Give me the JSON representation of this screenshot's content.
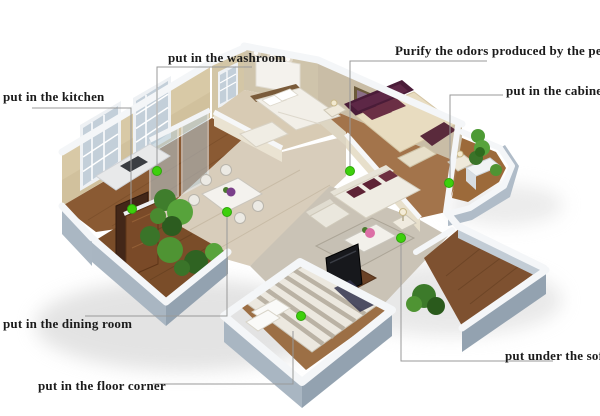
{
  "colors": {
    "background": "#ffffff",
    "label_text": "#1b1b1b",
    "leader_line": "#999999",
    "marker_fill": "#3ed00c",
    "marker_stroke": "#2ea50b"
  },
  "annotations": [
    {
      "id": "kitchen",
      "label": "put in the kitchen",
      "label_x": 3,
      "label_y": 90,
      "line": [
        [
          32,
          108
        ],
        [
          131,
          108
        ],
        [
          131,
          205
        ]
      ],
      "dot": [
        132,
        209
      ]
    },
    {
      "id": "washroom",
      "label": "put in the washroom",
      "label_x": 168,
      "label_y": 51,
      "line": [
        [
          252,
          67
        ],
        [
          157,
          67
        ],
        [
          157,
          166
        ]
      ],
      "dot": [
        157,
        171
      ]
    },
    {
      "id": "pets",
      "label": "Purify the odors produced by the pets",
      "label_x": 395,
      "label_y": 44,
      "line": [
        [
          487,
          61
        ],
        [
          350,
          61
        ],
        [
          350,
          166
        ]
      ],
      "dot": [
        350,
        171
      ]
    },
    {
      "id": "cabinet",
      "label": "put in the cabinet",
      "label_x": 506,
      "label_y": 84,
      "line": [
        [
          503,
          95
        ],
        [
          450,
          95
        ],
        [
          450,
          178
        ]
      ],
      "dot": [
        449,
        183
      ]
    },
    {
      "id": "dining-room",
      "label": "put in the dining room",
      "label_x": 3,
      "label_y": 317,
      "line": [
        [
          85,
          316
        ],
        [
          227,
          316
        ],
        [
          227,
          217
        ]
      ],
      "dot": [
        227,
        212
      ]
    },
    {
      "id": "floor-corner",
      "label": "put in the floor corner",
      "label_x": 38,
      "label_y": 379,
      "line": [
        [
          153,
          384
        ],
        [
          293,
          384
        ],
        [
          293,
          331
        ]
      ],
      "dot": [
        301,
        316
      ]
    },
    {
      "id": "sofa",
      "label": "put under the sofa",
      "label_x": 505,
      "label_y": 349,
      "line": [
        [
          553,
          361
        ],
        [
          401,
          361
        ],
        [
          401,
          243
        ]
      ],
      "dot": [
        401,
        238
      ]
    }
  ]
}
